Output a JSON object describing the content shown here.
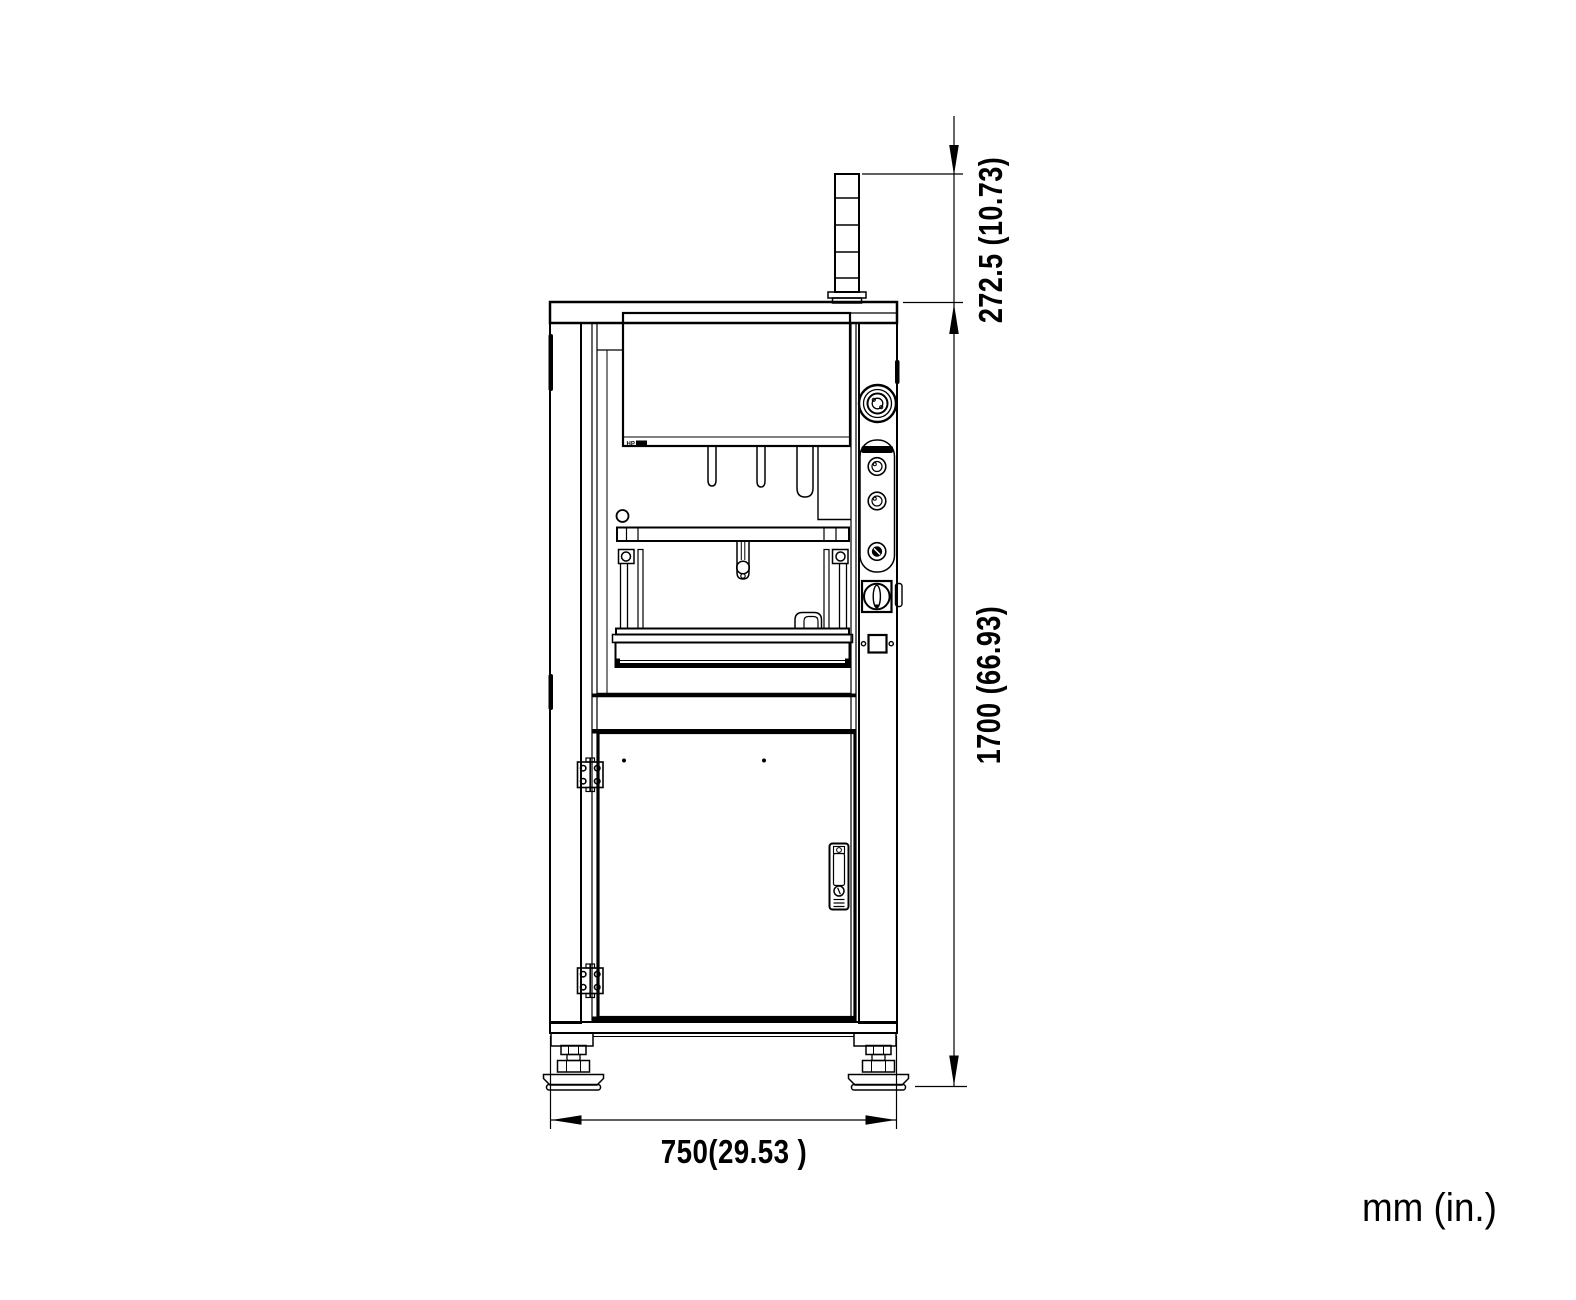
{
  "colors": {
    "line": "#000000",
    "background": "#ffffff"
  },
  "units_note": "mm (in.)",
  "display_panel": {
    "badge": "HP"
  },
  "dimensions": {
    "tower_extension": {
      "label": "272.5 (10.73)",
      "mm": 272.5,
      "inches": 10.73
    },
    "total_height": {
      "label": "1700 (66.93)",
      "mm": 1700,
      "inches": 66.93
    },
    "base_width": {
      "label": "750(29.53 )",
      "mm": 750,
      "inches": 29.53
    }
  }
}
